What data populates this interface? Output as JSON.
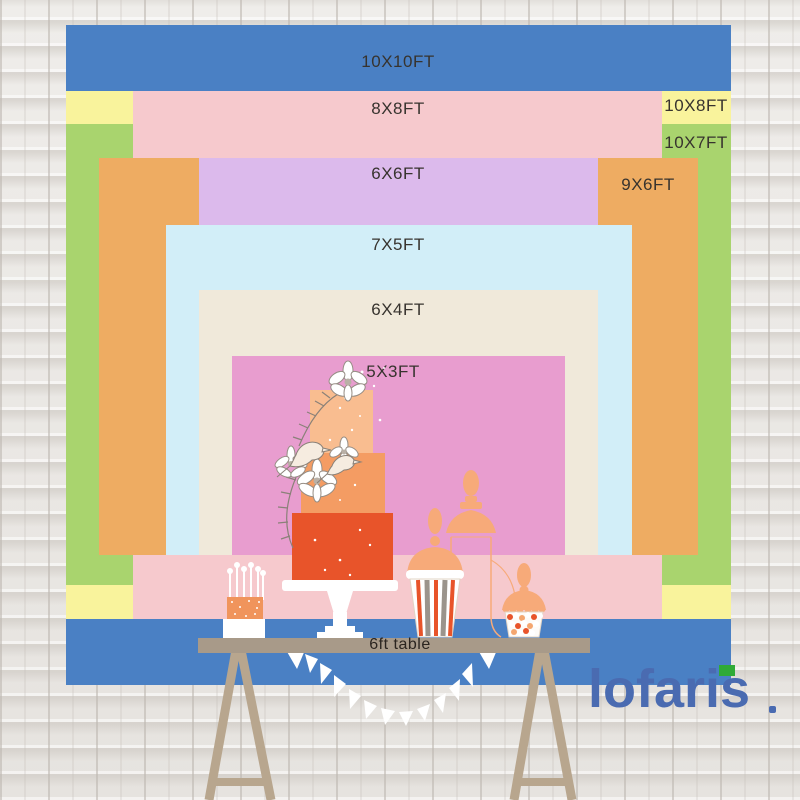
{
  "backdrop": {
    "layers": [
      {
        "name": "10x10ft",
        "label": "10X10FT",
        "color": "#4a80c4"
      },
      {
        "name": "10x8ft",
        "label": "10X8FT",
        "color": "#f9f39c"
      },
      {
        "name": "10x7ft",
        "label": "10X7FT",
        "color": "#a9d46e"
      },
      {
        "name": "8x8ft",
        "label": "8X8FT",
        "color": "#f6c9cd"
      },
      {
        "name": "9x6ft",
        "label": "9X6FT",
        "color": "#eeac62"
      },
      {
        "name": "6x6ft",
        "label": "6X6FT",
        "color": "#dcbaec"
      },
      {
        "name": "7x5ft",
        "label": "7X5FT",
        "color": "#d2eef8"
      },
      {
        "name": "6x4ft",
        "label": "6X4FT",
        "color": "#f0e9da"
      },
      {
        "name": "5x3ft",
        "label": "5X3FT",
        "color": "#e89dcf"
      }
    ],
    "table_label": "6ft table",
    "label_text_color": "#37332e"
  },
  "scene": {
    "wall": "white painted brick",
    "table_color": "#a89a89",
    "leg_color": "#b8a68e",
    "icons": [
      "three-tier-cake-illustration",
      "cake-pops-illustration",
      "popcorn-cup-illustration",
      "apothecary-jar-illustration",
      "candy-jar-illustration",
      "bunting-flags",
      "trestle-legs"
    ],
    "cake_tier_colors": [
      "#f9bd90",
      "#f49c63",
      "#e8542a"
    ],
    "silhouette_color": "#f7aa79"
  },
  "brand": {
    "logo_text": "lofaris",
    "logo_color": "#4a6bb1",
    "logo_accent_color": "#2faa37"
  }
}
